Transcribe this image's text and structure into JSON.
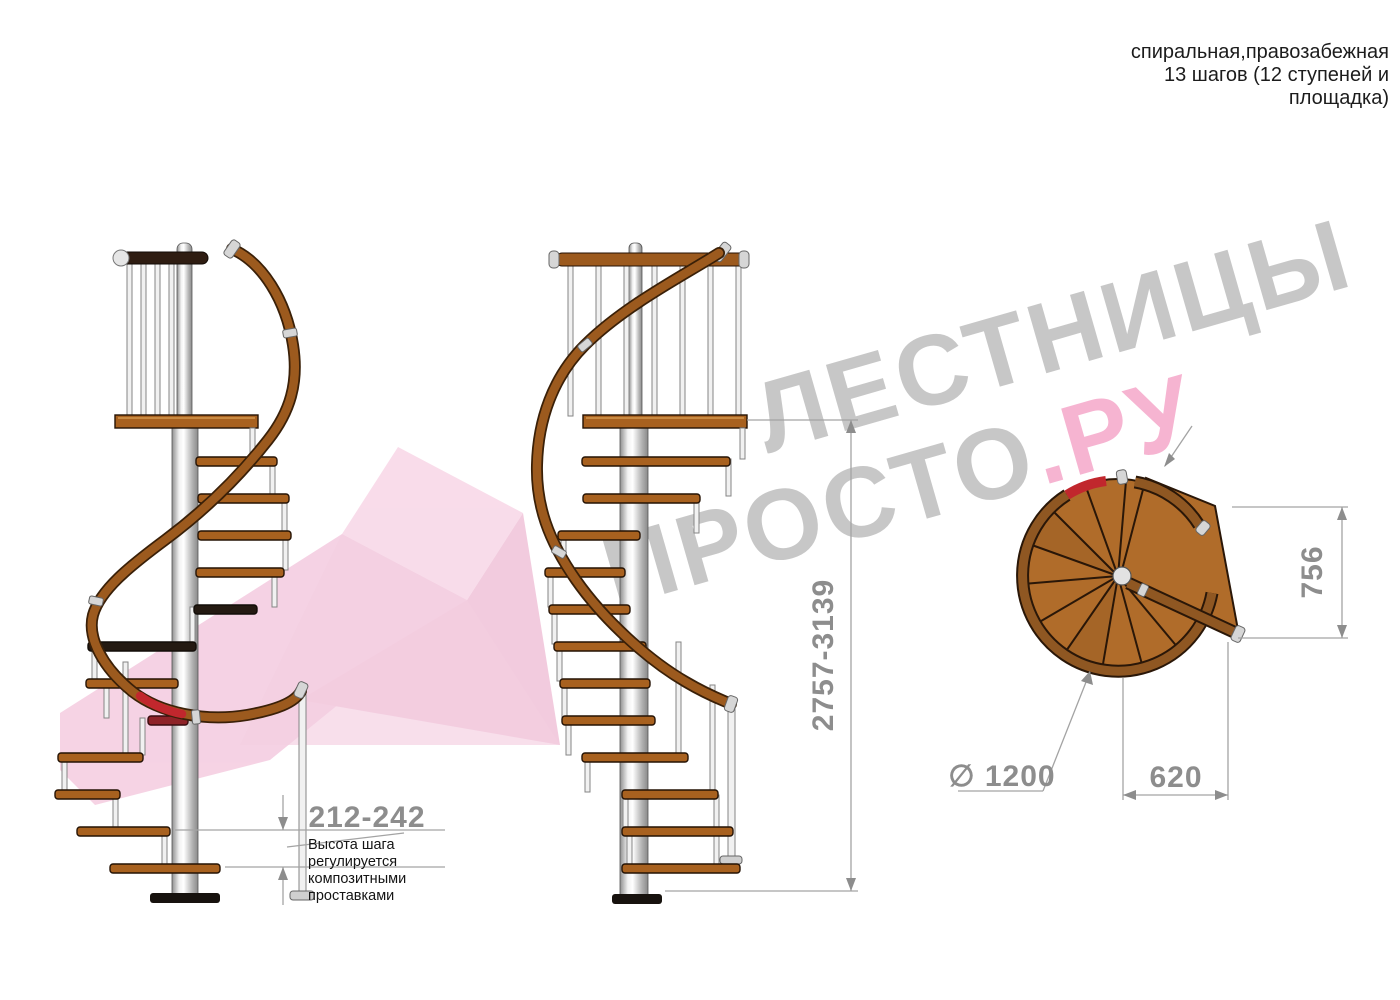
{
  "header": {
    "line1": "спиральная,правозабежная",
    "line2": "13 шагов (12 ступеней и",
    "line3": "площадка)"
  },
  "watermark": {
    "line1": "ЛЕСТНИЦЫ",
    "line2_gray": "ПРОСТО",
    "line2_pink": ".РУ"
  },
  "dimensions": {
    "step_height": "212-242",
    "note_line1": "Высота шага",
    "note_line2": "регулируется",
    "note_line3": "композитными",
    "note_line4": "проставками",
    "total_height": "2757-3139",
    "plan_depth": "756",
    "plan_width": "620",
    "plan_diameter": "∅ 1200"
  },
  "colors": {
    "wood": "#a8611f",
    "handrail_wood": "#9c5a1e",
    "dark_rail": "#2f1d12",
    "metal": "#d9d9d9",
    "dimension_gray": "#8d8d8d",
    "note_black": "#141414",
    "watermark_gray": "#b8b8b8",
    "watermark_pink": "#f49fc5",
    "accent_red": "#c1272d",
    "arrow_pink": "#f6cfe2"
  }
}
